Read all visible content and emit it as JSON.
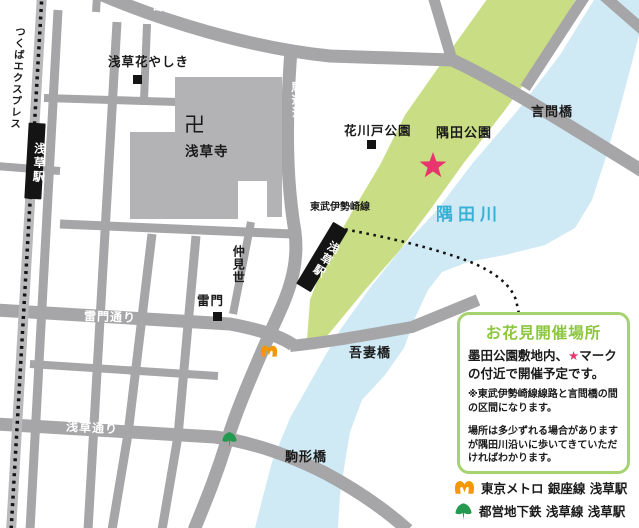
{
  "map": {
    "labels": {
      "yoto_dori": "言問通り",
      "tsukuba_express": "つくばエクスプレス",
      "tx_asakusa_station": "浅草駅",
      "hanayashiki": "浅草花やしき",
      "umamichi_dori": "馬道通り",
      "manji": "卍",
      "sensoji": "浅草寺",
      "hanakawado_park": "花川戸公園",
      "sumida_park": "隅田公園",
      "kototoi_bridge": "言問橋",
      "sumida_river": "隅田川",
      "tobu_isesaki_line": "東武伊勢崎線",
      "tobu_asakusa_station": "浅草駅",
      "nakamise": "仲見世",
      "kaminarimon": "雷門",
      "kaminarimon_dori": "雷門通り",
      "azuma_bridge": "吾妻橋",
      "asakusa_dori": "浅草通り",
      "edo_dori": "江戸通り",
      "komagata_bridge": "駒形橋"
    },
    "colors": {
      "road": "#a6a6a8",
      "building": "#b3b3b5",
      "park": "#c9dd84",
      "river": "#cfeaf5",
      "river_label": "#39b0d6",
      "star": "#e8356d",
      "rail_band": "#b9b9bb",
      "rail_black": "#141414",
      "marker_black": "#141414",
      "box_border": "#a6d26f",
      "box_title_green": "#8cc63f",
      "metro_orange": "#f39800",
      "toei_green": "#239a4f"
    }
  },
  "info_box": {
    "title": "お花見開催場所",
    "body_before_star": "墨田公園敷地内、",
    "body_star": "★",
    "body_after_star": "マークの付近で開催予定です。",
    "note1": "※東武伊勢崎線線路と言問橋の間の区間になります。",
    "note2": "場所は多少ずれる場合がありますが隅田川沿いに歩いてきていただければわかります。"
  },
  "legend": {
    "items": [
      {
        "icon": "tokyo-metro-icon",
        "label": "東京メトロ 銀座線 浅草駅"
      },
      {
        "icon": "toei-subway-icon",
        "label": "都営地下鉄 浅草線 浅草駅"
      }
    ]
  }
}
